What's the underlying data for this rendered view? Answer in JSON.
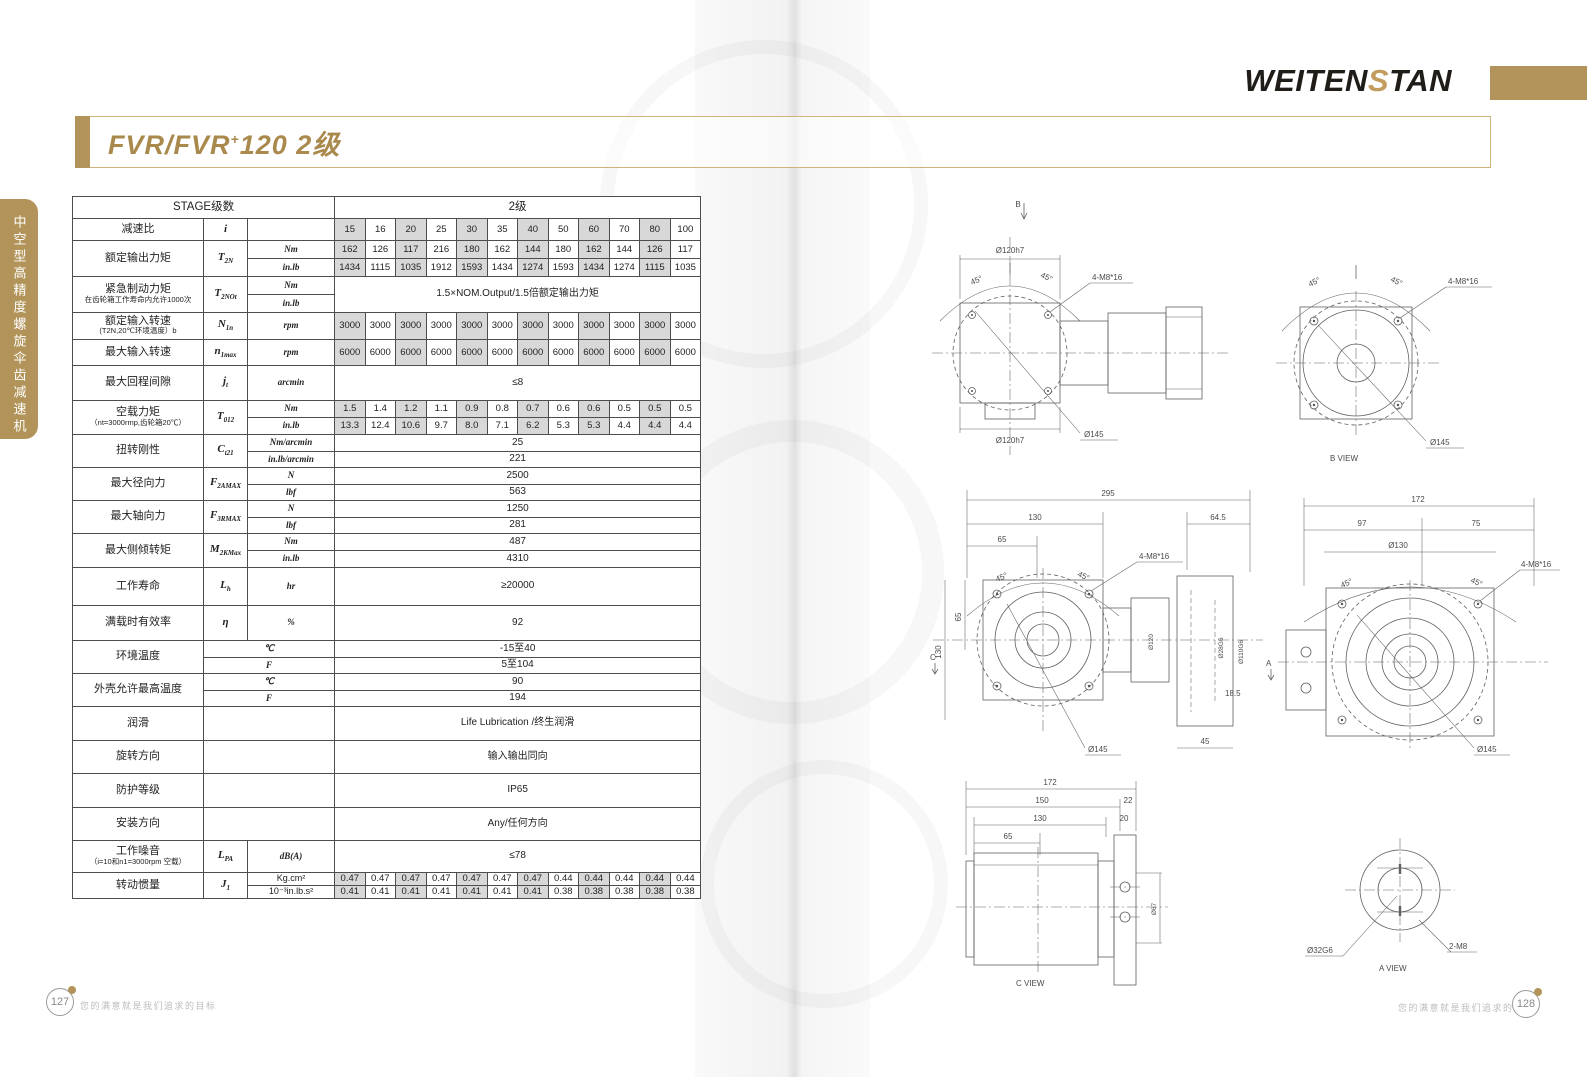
{
  "page": {
    "brand": {
      "pre": "WEITEN",
      "mid": "S",
      "post": "TAN"
    },
    "title": {
      "prefix": "FVR/FVR",
      "sup": "+",
      "suffix": "120  2级"
    },
    "sidebar_text": "中空型高精度螺旋伞齿减速机",
    "footer": {
      "left_page": "127",
      "right_page": "128",
      "slogan": "您的满意就是我们追求的目标"
    },
    "accent_color": "#b2945a"
  },
  "table": {
    "header": {
      "left": "STAGE级数",
      "right": "2级"
    },
    "rows": [
      {
        "label": "减速比",
        "sym": {
          "m": "i",
          "s": ""
        },
        "sub": [
          {
            "unit": "",
            "values": [
              "15",
              "16",
              "20",
              "25",
              "30",
              "35",
              "40",
              "50",
              "60",
              "70",
              "80",
              "100"
            ]
          }
        ]
      },
      {
        "label": "额定输出力矩",
        "sym": {
          "m": "T",
          "s": "2N"
        },
        "sub": [
          {
            "unit": "Nm",
            "values": [
              "162",
              "126",
              "117",
              "216",
              "180",
              "162",
              "144",
              "180",
              "162",
              "144",
              "126",
              "117"
            ]
          },
          {
            "unit": "in.lb",
            "values": [
              "1434",
              "1115",
              "1035",
              "1912",
              "1593",
              "1434",
              "1274",
              "1593",
              "1434",
              "1274",
              "1115",
              "1035"
            ]
          }
        ]
      },
      {
        "label": "紧急制动力矩",
        "sublabel": "在齿轮箱工作寿命内允许1000次",
        "sym": {
          "m": "T",
          "s": "2NOt"
        },
        "span_all": "1.5×NOM.Output/1.5倍额定输出力矩",
        "sub": [
          {
            "unit": "Nm"
          },
          {
            "unit": "in.lb"
          }
        ]
      },
      {
        "label": "额定输入转速",
        "sublabel": "(T2N,20℃环境温度）b",
        "sym": {
          "m": "N",
          "s": "1n"
        },
        "sub": [
          {
            "unit": "rpm",
            "values": [
              "3000",
              "3000",
              "3000",
              "3000",
              "3000",
              "3000",
              "3000",
              "3000",
              "3000",
              "3000",
              "3000",
              "3000"
            ]
          }
        ]
      },
      {
        "label": "最大输入转速",
        "sym": {
          "m": "n",
          "s": "1max"
        },
        "sub": [
          {
            "unit": "rpm",
            "values": [
              "6000",
              "6000",
              "6000",
              "6000",
              "6000",
              "6000",
              "6000",
              "6000",
              "6000",
              "6000",
              "6000",
              "6000"
            ]
          }
        ]
      },
      {
        "label": "最大回程间隙",
        "sym": {
          "m": "j",
          "s": "t"
        },
        "sub": [
          {
            "unit": "arcmin",
            "span": "≤8"
          }
        ]
      },
      {
        "label": "空载力矩",
        "sublabel": "（nt=3000rmp,齿轮箱20℃）",
        "sym": {
          "m": "T",
          "s": "012"
        },
        "sub": [
          {
            "unit": "Nm",
            "values": [
              "1.5",
              "1.4",
              "1.2",
              "1.1",
              "0.9",
              "0.8",
              "0.7",
              "0.6",
              "0.6",
              "0.5",
              "0.5",
              "0.5"
            ]
          },
          {
            "unit": "in.lb",
            "values": [
              "13.3",
              "12.4",
              "10.6",
              "9.7",
              "8.0",
              "7.1",
              "6.2",
              "5.3",
              "5.3",
              "4.4",
              "4.4",
              "4.4"
            ]
          }
        ]
      },
      {
        "label": "扭转刚性",
        "sym": {
          "m": "C",
          "s": "t21"
        },
        "sub": [
          {
            "unit": "Nm/arcmin",
            "span": "25"
          },
          {
            "unit": "in.lb/arcmin",
            "span": "221"
          }
        ]
      },
      {
        "label": "最大径向力",
        "sym": {
          "m": "F",
          "s": "2AMAX"
        },
        "sub": [
          {
            "unit": "N",
            "span": "2500"
          },
          {
            "unit": "lbf",
            "span": "563"
          }
        ]
      },
      {
        "label": "最大轴向力",
        "sym": {
          "m": "F",
          "s": "3RMAX"
        },
        "sub": [
          {
            "unit": "N",
            "span": "1250"
          },
          {
            "unit": "lbf",
            "span": "281"
          }
        ]
      },
      {
        "label": "最大侧倾转矩",
        "sym": {
          "m": "M",
          "s": "2KMax"
        },
        "sub": [
          {
            "unit": "Nm",
            "span": "487"
          },
          {
            "unit": "in.lb",
            "span": "4310"
          }
        ]
      },
      {
        "label": "工作寿命",
        "sym": {
          "m": "L",
          "s": "h"
        },
        "sub": [
          {
            "unit": "hr",
            "span": "≥20000"
          }
        ]
      },
      {
        "label": "满载时有效率",
        "sym": {
          "m": "η",
          "s": ""
        },
        "sub": [
          {
            "unit": "%",
            "span": "92"
          }
        ]
      },
      {
        "label": "环境温度",
        "merge_su": true,
        "sub": [
          {
            "unit": "℃",
            "span": "-15至40"
          },
          {
            "unit": "F",
            "span": "5至104"
          }
        ]
      },
      {
        "label": "外壳允许最高温度",
        "merge_su": true,
        "sub": [
          {
            "unit": "℃",
            "span": "90"
          },
          {
            "unit": "F",
            "span": "194"
          }
        ]
      },
      {
        "label": "润滑",
        "merge_su": true,
        "sub": [
          {
            "unit": "",
            "span": "Life Lubrication /终生润滑"
          }
        ]
      },
      {
        "label": "旋转方向",
        "merge_su": true,
        "sub": [
          {
            "unit": "",
            "span": "输入输出同向"
          }
        ]
      },
      {
        "label": "防护等级",
        "merge_su": true,
        "sub": [
          {
            "unit": "",
            "span": "IP65"
          }
        ]
      },
      {
        "label": "安装方向",
        "merge_su": true,
        "sub": [
          {
            "unit": "",
            "span": "Any/任何方向"
          }
        ]
      },
      {
        "label": "工作噪音",
        "sublabel": "（i=10和n1=3000rpm 空载）",
        "sym": {
          "m": "L",
          "s": "PA"
        },
        "sub": [
          {
            "unit": "dB(A)",
            "span": "≤78"
          }
        ]
      },
      {
        "label": "转动惯量",
        "sym": {
          "m": "J",
          "s": "1"
        },
        "sub": [
          {
            "unit": "Kg.cm²",
            "values": [
              "0.47",
              "0.47",
              "0.47",
              "0.47",
              "0.47",
              "0.47",
              "0.47",
              "0.44",
              "0.44",
              "0.44",
              "0.44",
              "0.44"
            ]
          },
          {
            "unit": "10⁻³in.lb.s²",
            "values": [
              "0.41",
              "0.41",
              "0.41",
              "0.41",
              "0.41",
              "0.41",
              "0.41",
              "0.38",
              "0.38",
              "0.38",
              "0.38",
              "0.38"
            ]
          }
        ]
      }
    ]
  },
  "drawings": {
    "front_top": {
      "arrow": "B",
      "dia_top": "Ø120h7",
      "dia_bottom": "Ø120h7",
      "ang_l": "45°",
      "ang_r": "45°",
      "bolt": "4-M8*16",
      "dia": "Ø145"
    },
    "b_view": {
      "title": "B VIEW",
      "ang_l": "45°",
      "ang_r": "45°",
      "bolt": "4-M8*16",
      "dia": "Ø145"
    },
    "side": {
      "arrow": "C",
      "d295": "295",
      "d130": "130",
      "d65": "65",
      "d64_5": "64.5",
      "d130l": "130",
      "d65l": "65",
      "ang_l": "45°",
      "ang_r": "45°",
      "bolt": "4-M8*16",
      "dia": "Ø145",
      "d120": "Ø120",
      "d28": "Ø28G6",
      "d110": "Ø110G6",
      "d18_5": "18.5",
      "d45": "45"
    },
    "front_a": {
      "arrow": "A",
      "d172": "172",
      "d97": "97",
      "d75": "75",
      "d130": "Ø130",
      "ang_l": "45°",
      "ang_r": "45°",
      "bolt": "4-M8*16",
      "dia": "Ø145"
    },
    "c_view": {
      "title": "C VIEW",
      "d172": "172",
      "d150": "150",
      "d130": "130",
      "d65": "65",
      "d22": "22",
      "d20": "20",
      "d67": "Ø67"
    },
    "a_view": {
      "title": "A VIEW",
      "d32": "Ø32G6",
      "m8": "2-M8"
    }
  }
}
